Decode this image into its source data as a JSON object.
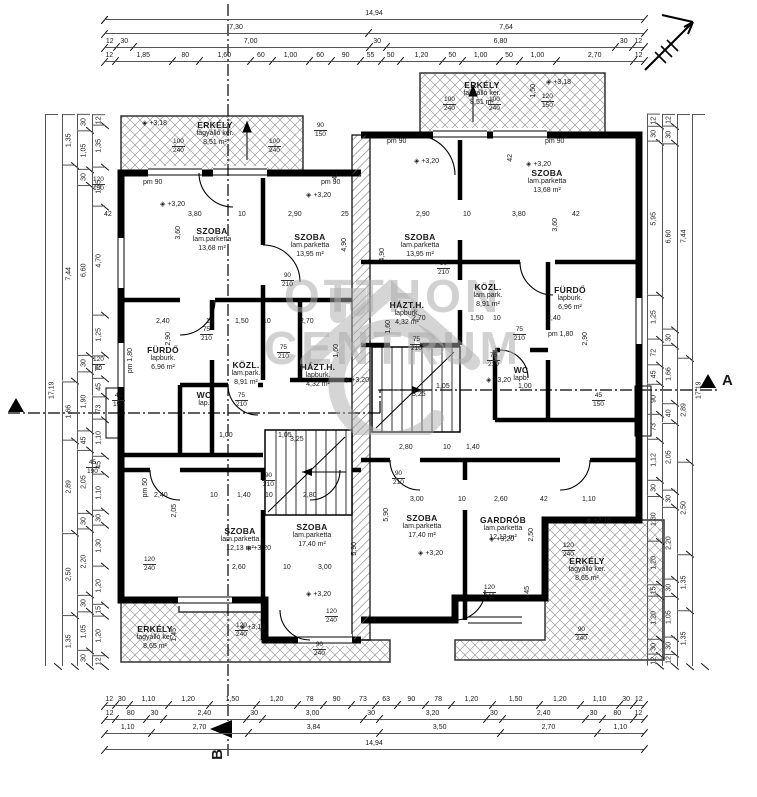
{
  "watermark": {
    "line1": "OTTHON",
    "line2": "CENTRUM"
  },
  "sections": {
    "a": "A",
    "b": "B"
  },
  "dims": {
    "top": {
      "total": "14,94",
      "halves": [
        "7,30",
        "7,64"
      ],
      "axes": [
        "12",
        "30",
        "7,00",
        "30",
        "6,80",
        "30",
        "12"
      ],
      "detail": [
        "12",
        "1,85",
        "80",
        "1,60",
        "60",
        "1,00",
        "60",
        "90",
        "55",
        "50",
        "1,20",
        "50",
        "1,00",
        "50",
        "1,00",
        "2,70",
        "12"
      ]
    },
    "bottom": {
      "openings": [
        "12",
        "30",
        "1,10",
        "1,20",
        "1,50",
        "1,20",
        "78",
        "90",
        "73",
        "63",
        "90",
        "78",
        "1,20",
        "1,50",
        "1,20",
        "1,10",
        "30",
        "12"
      ],
      "axes": [
        "12",
        "80",
        "30",
        "2,40",
        "30",
        "3,00",
        "30",
        "3,20",
        "30",
        "2,40",
        "30",
        "80",
        "12"
      ],
      "groups": [
        "1,10",
        "2,70",
        "3,84",
        "3,50",
        "2,70",
        "1,10"
      ],
      "total": "14,94"
    },
    "left": {
      "total": "17,19",
      "outer": [
        "1,35",
        "7,44",
        "1,66",
        "2,89",
        "2,50",
        "1,35"
      ],
      "mid": [
        "30",
        "1,05",
        "30",
        "6,60",
        "30",
        "1,90",
        "45",
        "2,05",
        "30",
        "2,20",
        "30",
        "1,05",
        "30"
      ],
      "inner": [
        "12",
        "1,35",
        "1,25",
        "4,70",
        "1,25",
        "73",
        "45",
        "73",
        "1,10",
        "45",
        "1,10",
        "30",
        "1,30",
        "1,20",
        "15",
        "1,20",
        "12"
      ]
    },
    "right": {
      "total": "17,19",
      "inner": [
        "12",
        "30",
        "5,95",
        "1,25",
        "72",
        "45",
        "90",
        "73",
        "1,12",
        "30",
        "1,30",
        "1,20",
        "15",
        "1,20",
        "30",
        "12"
      ],
      "mid": [
        "12",
        "30",
        "6,60",
        "30",
        "1,66",
        "40",
        "2,05",
        "30",
        "2,20",
        "30",
        "1,05",
        "30",
        "12"
      ],
      "outer": [
        "7,44",
        "2,89",
        "2,50",
        "1,35",
        "1,35"
      ]
    }
  },
  "rooms": [
    {
      "name": "SZOBA",
      "finish": "lam.parketta",
      "area": "13,68 m²"
    },
    {
      "name": "SZOBA",
      "finish": "lam.parketta",
      "area": "13,95 m²"
    },
    {
      "name": "FÜRDŐ",
      "finish": "lapburk.",
      "area": "6,96 m²"
    },
    {
      "name": "KÖZL.",
      "finish": "lam.park.",
      "area": "8,91 m²"
    },
    {
      "name": "HÁZT.H.",
      "finish": "lapburk.",
      "area": "4,32 m²"
    },
    {
      "name": "WC",
      "finish": "lap.",
      "area": ""
    },
    {
      "name": "SZOBA",
      "finish": "lam.parketta",
      "area": "12,13 m²"
    },
    {
      "name": "SZOBA",
      "finish": "lam.parketta",
      "area": "17,40 m²"
    },
    {
      "name": "ERKÉLY",
      "finish": "fagyálló ker.",
      "area": "8,51 m²"
    },
    {
      "name": "ERKÉLY",
      "finish": "fagyálló ker.",
      "area": "8,65 m²"
    },
    {
      "name": "SZOBA",
      "finish": "lam.parketta",
      "area": "13,95 m²"
    },
    {
      "name": "SZOBA",
      "finish": "lam.parketta",
      "area": "13,68 m²"
    },
    {
      "name": "KÖZL.",
      "finish": "lam.park.",
      "area": "8,91 m²"
    },
    {
      "name": "FÜRDŐ",
      "finish": "lapburk.",
      "area": "6,96 m²"
    },
    {
      "name": "HÁZT.H.",
      "finish": "lapburk.",
      "area": "4,32 m²"
    },
    {
      "name": "WC",
      "finish": "lapb.",
      "area": ""
    },
    {
      "name": "SZOBA",
      "finish": "lam.parketta",
      "area": "17,40 m²"
    },
    {
      "name": "GARDRÓB",
      "finish": "lam.parketta",
      "area": "12,13 m²"
    },
    {
      "name": "ERKÉLY",
      "finish": "fagyálló ker.",
      "area": "8,51 m²"
    },
    {
      "name": "ERKÉLY",
      "finish": "fagyálló ker.",
      "area": "8,65 m²"
    }
  ],
  "labels": [
    "42",
    "3,80",
    "10",
    "2,90",
    "25",
    "2,90",
    "10",
    "3,80",
    "42",
    "2,40",
    "10",
    "1,50",
    "10",
    "2,70",
    "2,70",
    "1,50",
    "10",
    "2,40",
    "3,25",
    "3,25",
    "2,60",
    "10",
    "3,00",
    "3,00",
    "10",
    "2,60",
    "42",
    "1,10",
    "2,40",
    "10",
    "1,40",
    "10",
    "2,80",
    "2,80",
    "10",
    "1,40",
    "1,05",
    "1,00",
    "1,05",
    "1,00",
    "3,60",
    "4,90",
    "2,90",
    "1,60",
    "3,60",
    "4,90",
    "2,90",
    "1,60",
    "5,90",
    "5,90",
    "2,50",
    "2,05",
    "1,45",
    "1,45",
    "1,50",
    "pm 90",
    "pm 90",
    "pm 90",
    "pm 90",
    "pm 1,80",
    "pm 1,80",
    "pm 50",
    "+3,20",
    "+3,20",
    "+3,20",
    "+3,20",
    "+3,20",
    "+3,20",
    "+3,20",
    "+3,20",
    "+3,20",
    "+3,20",
    "+3,18",
    "+3,18",
    "+3,18",
    "+3,18",
    "42",
    "42"
  ],
  "stacked": [
    {
      "a": "100",
      "b": "240"
    },
    {
      "a": "100",
      "b": "240"
    },
    {
      "a": "100",
      "b": "240"
    },
    {
      "a": "100",
      "b": "240"
    },
    {
      "a": "120",
      "b": "150"
    },
    {
      "a": "90",
      "b": "150"
    },
    {
      "a": "120",
      "b": "150"
    },
    {
      "a": "120",
      "b": "60"
    },
    {
      "a": "45",
      "b": "150"
    },
    {
      "a": "45",
      "b": "150"
    },
    {
      "a": "45",
      "b": "190"
    },
    {
      "a": "120",
      "b": "240"
    },
    {
      "a": "120",
      "b": "240"
    },
    {
      "a": "120",
      "b": "240"
    },
    {
      "a": "120",
      "b": "240"
    },
    {
      "a": "120",
      "b": "240"
    },
    {
      "a": "90",
      "b": "240"
    },
    {
      "a": "90",
      "b": "240"
    },
    {
      "a": "90",
      "b": "210"
    },
    {
      "a": "90",
      "b": "210"
    },
    {
      "a": "75",
      "b": "210"
    },
    {
      "a": "75",
      "b": "210"
    },
    {
      "a": "75",
      "b": "210"
    },
    {
      "a": "75",
      "b": "210"
    },
    {
      "a": "90",
      "b": "210"
    },
    {
      "a": "90",
      "b": "210"
    },
    {
      "a": "75",
      "b": "210"
    },
    {
      "a": "75",
      "b": "210"
    }
  ]
}
